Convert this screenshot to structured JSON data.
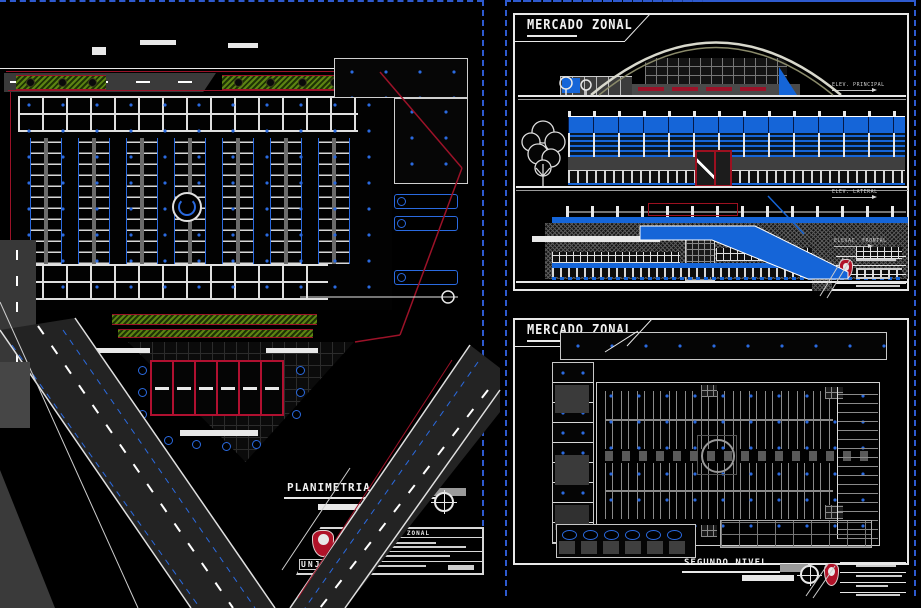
{
  "colors": {
    "cad_blue": "#1565d8",
    "marker_blue": "#2a6ae0",
    "cad_red": "#9c1228",
    "emblem_red": "#b01228",
    "vegetation_green": "#5d8412",
    "road_gray": "#3a3a3a",
    "sheet_frame_blue": "#2e5ace",
    "line_white": "#e8e8e8"
  },
  "left_sheet": {
    "plan_label": "PLANIMETRIA GENERAL",
    "title_block": {
      "project": "MERCADO ZONAL",
      "org": "UNJBG"
    }
  },
  "top_right_sheet": {
    "title": "MERCADO ZONAL",
    "elevation_labels": {
      "top": "ELEV. PRINCIPAL",
      "middle": "ELEV. LATERAL",
      "bottom": "ELEVAC. FRONTAL"
    }
  },
  "bottom_right_sheet": {
    "title": "MERCADO ZONAL",
    "plan_label": "SEGUNDO NIVEL"
  }
}
